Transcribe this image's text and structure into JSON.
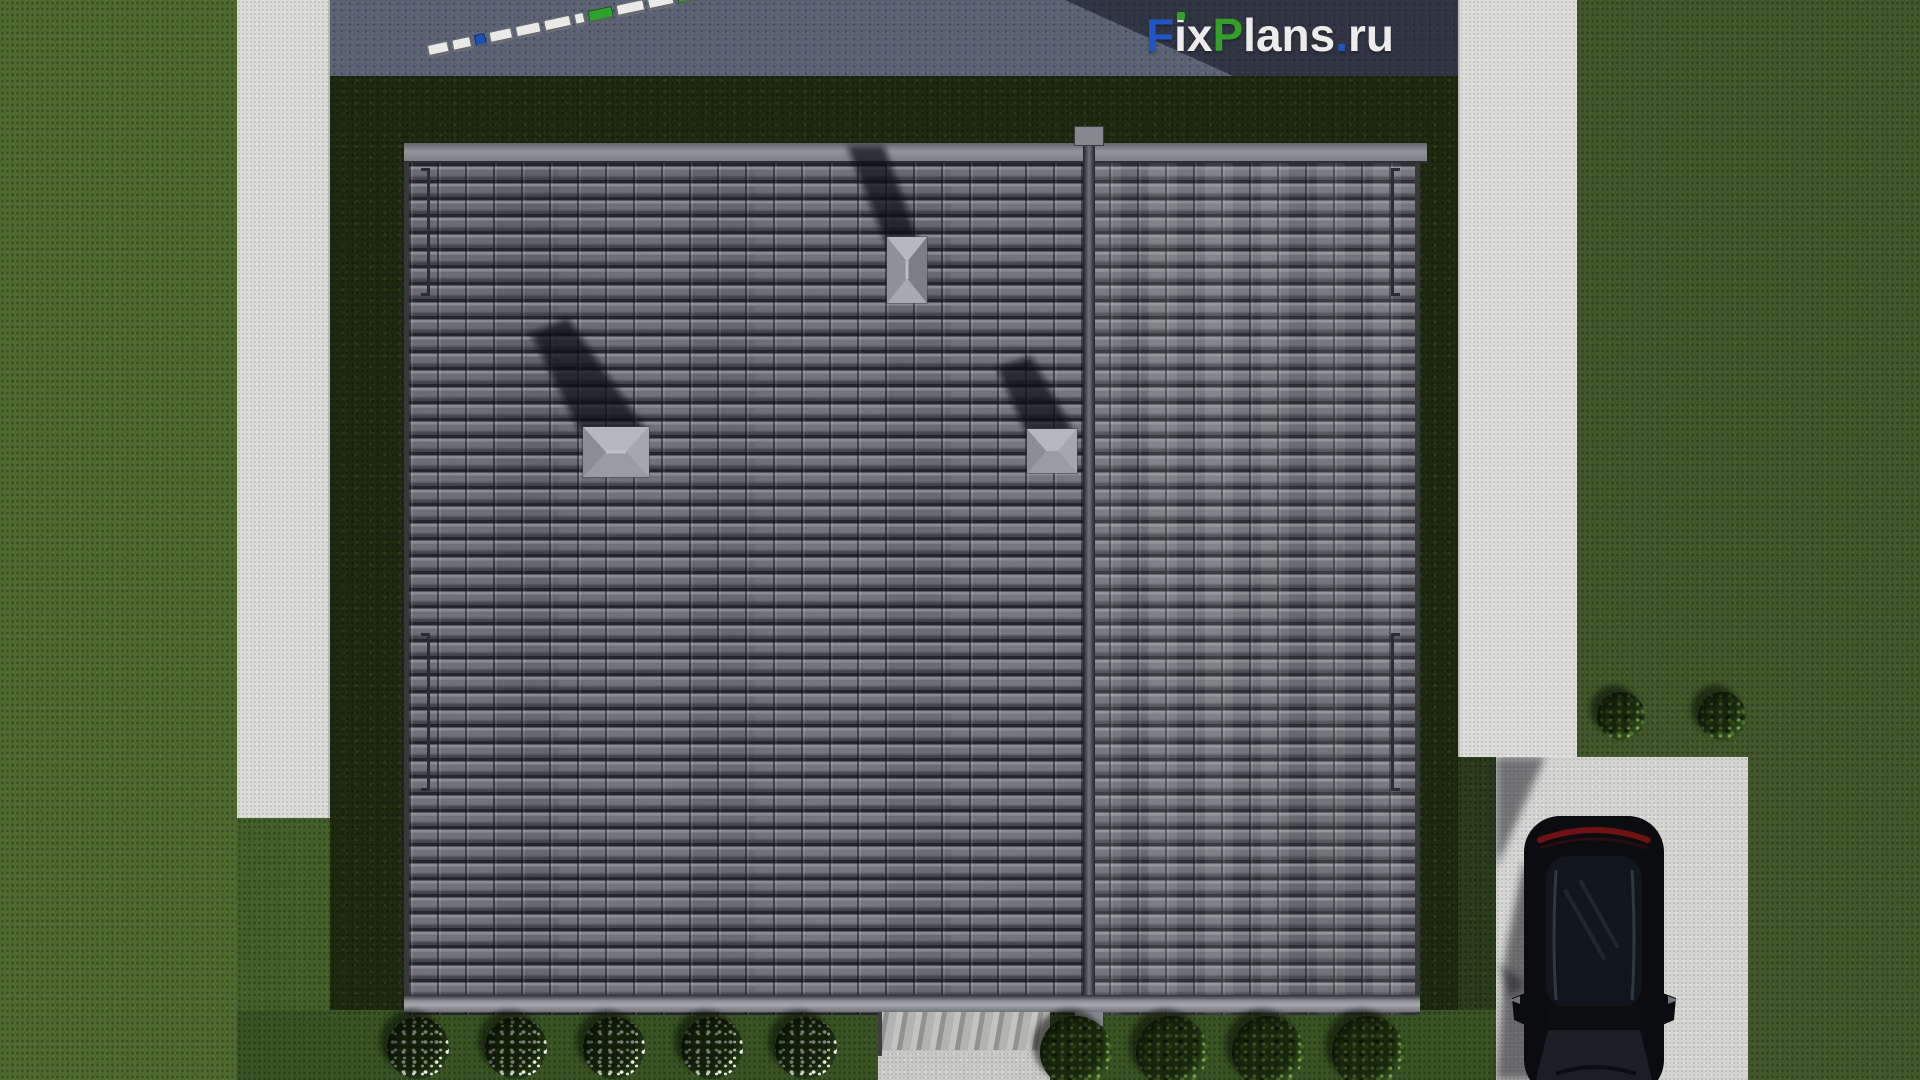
{
  "scene": {
    "title": "Top-down 3D render of a single-family house roof plan with yard, sidewalks, driveway and parked car",
    "view": "aerial top-down",
    "objects": {
      "roof": {
        "material": "gray tile",
        "sections": 2,
        "ridge_orientation": "vertical",
        "vents": 3,
        "snow_rails": 4
      },
      "car": {
        "color": "black",
        "type": "SUV, parked on driveway, rear facing street"
      },
      "flower_bushes_count": 5,
      "green_shrubs_bottom_count": 4,
      "green_shrubs_right_count": 2,
      "street_objects_note": "diagonal row of small white/blue/green rectangles on road at top"
    },
    "fence_segments": [
      "#e9e9e7",
      "#e9e9e7",
      "#1c4fba",
      "#e9e9e7",
      "#e9e9e7",
      "#e9e9e7",
      "#e9e9e7",
      "#2ea32c",
      "#e9e9e7",
      "#e9e9e7",
      "#2ea32c"
    ]
  },
  "watermark": {
    "text": "FixPlans.ru",
    "parts": [
      {
        "text": "F",
        "color": "#1f55c4"
      },
      {
        "text": "i",
        "color": "#ececec",
        "dot_color": "#33a02a"
      },
      {
        "text": "x",
        "color": "#ececec"
      },
      {
        "text": "P",
        "color": "#33a02a"
      },
      {
        "text": "lans",
        "color": "#ececec"
      },
      {
        "text": ".",
        "color": "#1f55c4"
      },
      {
        "text": "ru",
        "color": "#ececec"
      }
    ]
  },
  "palette": {
    "grass_outer_left": "#4f692e",
    "grass_outer_right": "#42582a",
    "grass_yard_dark": "#1d2a10",
    "grass_bottom": "#3a5323",
    "road_asphalt": "#5a6172",
    "building_shadow": "rgba(16,18,30,0.55)",
    "sidewalk": "#dbdbd8",
    "driveway": "#d5d5d3",
    "roof_tile": "#696c72",
    "roof_tile_gap": "#24262b",
    "roof_trim": "#8f9298",
    "vent_cap": "#9a9da2",
    "car_body": "#0a0c0f",
    "car_taillight": "#701114",
    "flower": "#ffffff",
    "shrub": "#2c451a"
  }
}
